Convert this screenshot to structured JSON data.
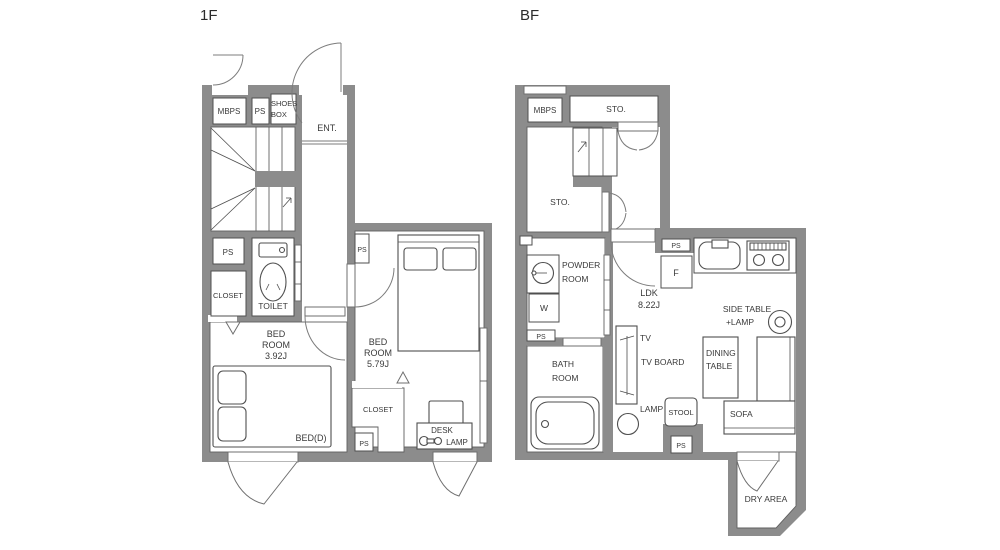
{
  "plans": {
    "f1": {
      "title": "1F",
      "rooms": {
        "mbps": "MBPS",
        "ps_top": "PS",
        "shoes_box_line1": "SHOES",
        "shoes_box_line2": "BOX",
        "entrance": "ENT.",
        "ps_mid": "PS",
        "closet_left": "CLOSET",
        "toilet": "TOILET",
        "bedroom1_line1": "BED",
        "bedroom1_line2": "ROOM",
        "bedroom1_line3": "3.92J",
        "bed_double": "BED(D)",
        "ps_bedroom2": "PS",
        "bedroom2_line1": "BED",
        "bedroom2_line2": "ROOM",
        "bedroom2_line3": "5.79J",
        "closet_bedroom2": "CLOSET",
        "ps_bottom": "PS",
        "desk": "DESK",
        "desk_lamp": "LAMP"
      }
    },
    "bf": {
      "title": "BF",
      "rooms": {
        "mbps": "MBPS",
        "storage_top": "STO.",
        "storage_main": "STO.",
        "powder_line1": "POWDER",
        "powder_line2": "ROOM",
        "washer": "W",
        "ps_left": "PS",
        "bath_line1": "BATH",
        "bath_line2": "ROOM",
        "ps_ldk": "PS",
        "fridge": "F",
        "ldk_line1": "LDK",
        "ldk_line2": "8.22J",
        "side_table_line1": "SIDE TABLE",
        "side_table_line2": "+LAMP",
        "tv": "TV",
        "tv_board": "TV BOARD",
        "dining_line1": "DINING",
        "dining_line2": "TABLE",
        "sofa": "SOFA",
        "lamp": "LAMP",
        "stool": "STOOL",
        "ps_bottom": "PS",
        "dry_area": "DRY AREA"
      }
    }
  },
  "colors": {
    "wall": "#8c8c8c",
    "line": "#4f4f4f",
    "text": "#3a3a3a",
    "background": "#ffffff"
  }
}
